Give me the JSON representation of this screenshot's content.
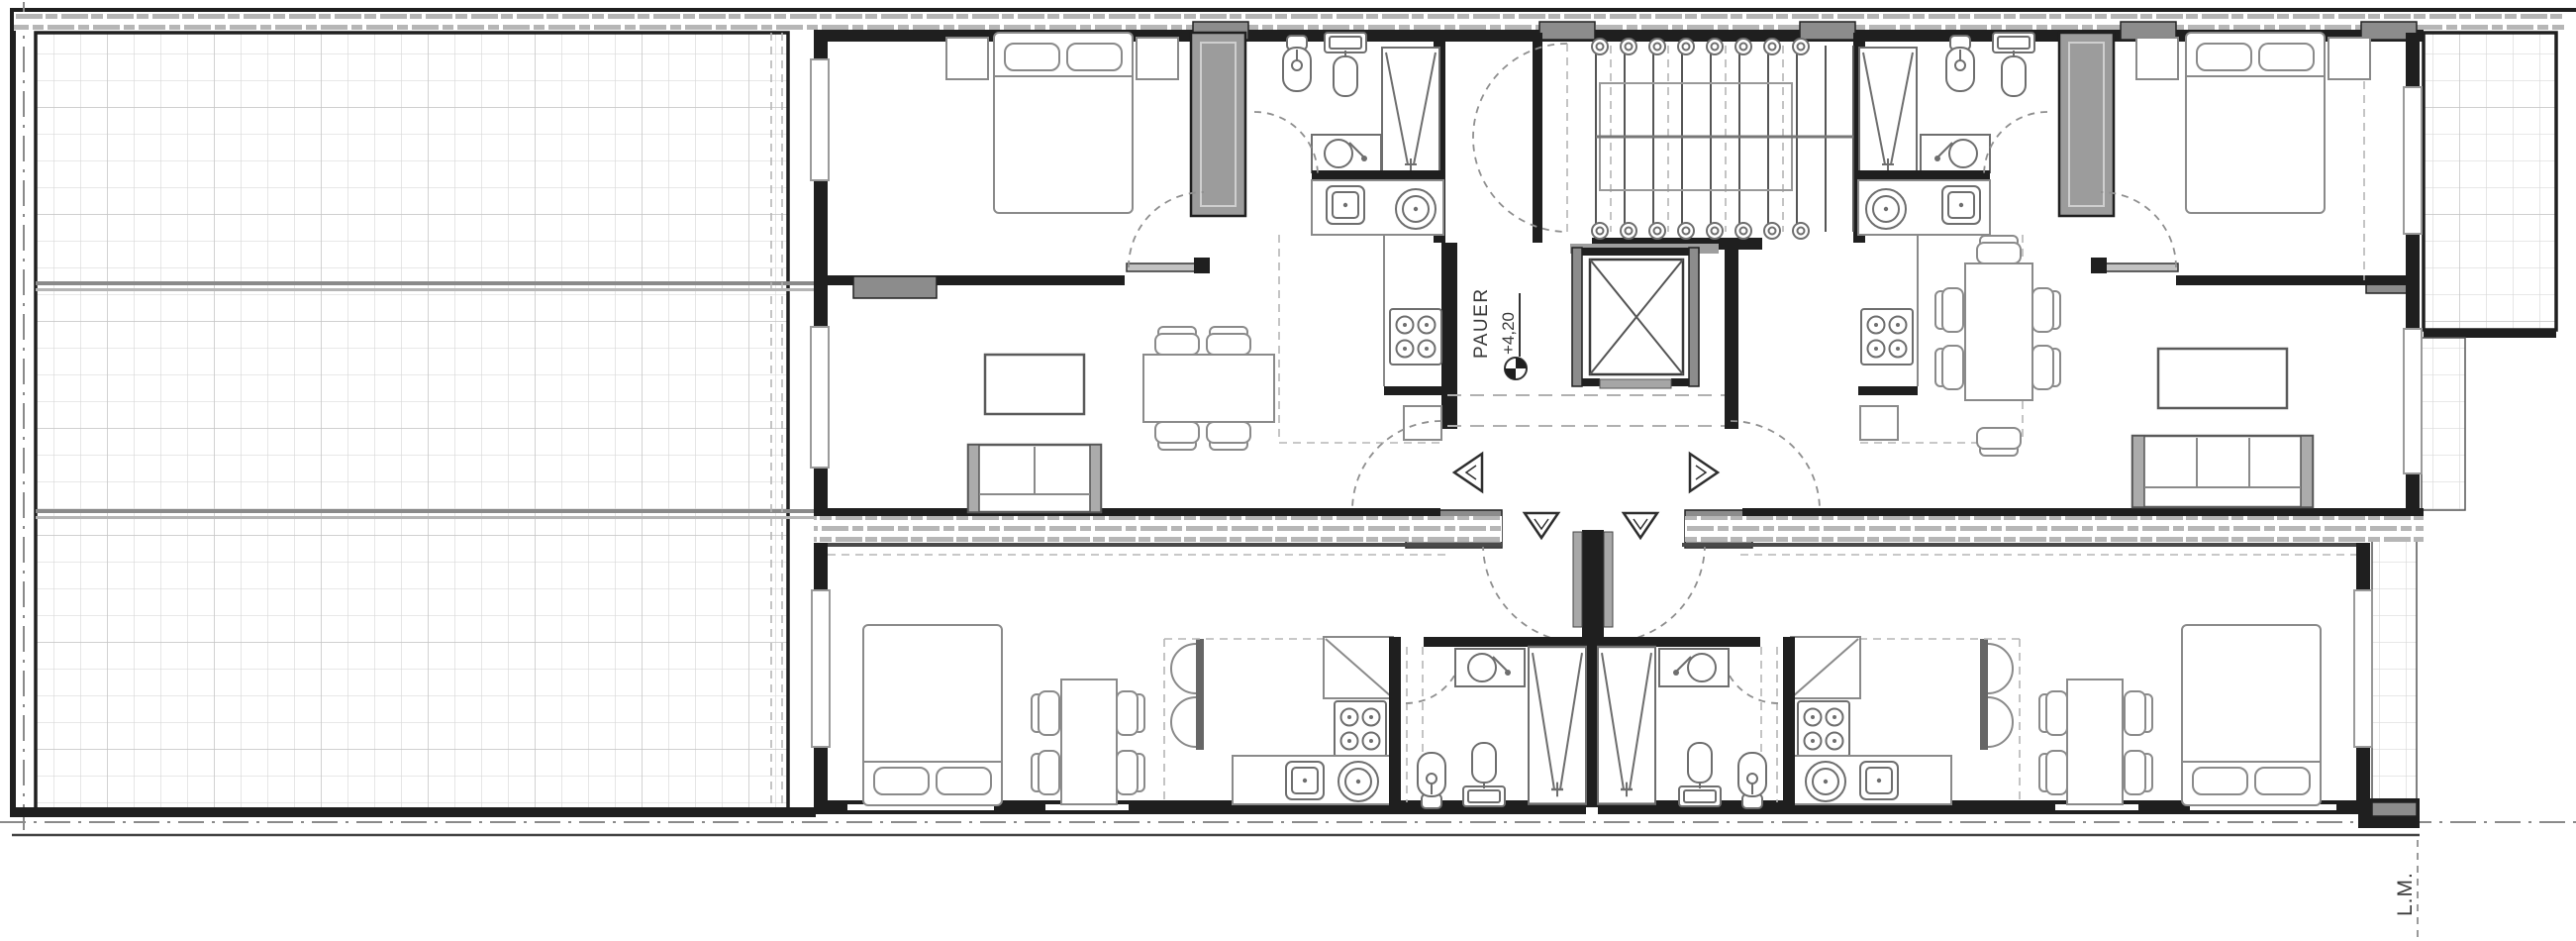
{
  "labels": {
    "stair_core": "PAUER",
    "level": "+4,20",
    "property_line": "L.M."
  },
  "colors": {
    "background": "#ffffff",
    "wall": "#1f1f1f",
    "column_fill": "#8c8c8c",
    "furniture_line": "#8a8a8a",
    "fixture_line": "#6e6e6e",
    "grid_line": "#d9d9d9",
    "grid_major_line": "#c4c4c4",
    "hatch_dash": "#b6b6b6",
    "dashed_line": "#9a9a9a",
    "text": "#3a3a3a"
  }
}
